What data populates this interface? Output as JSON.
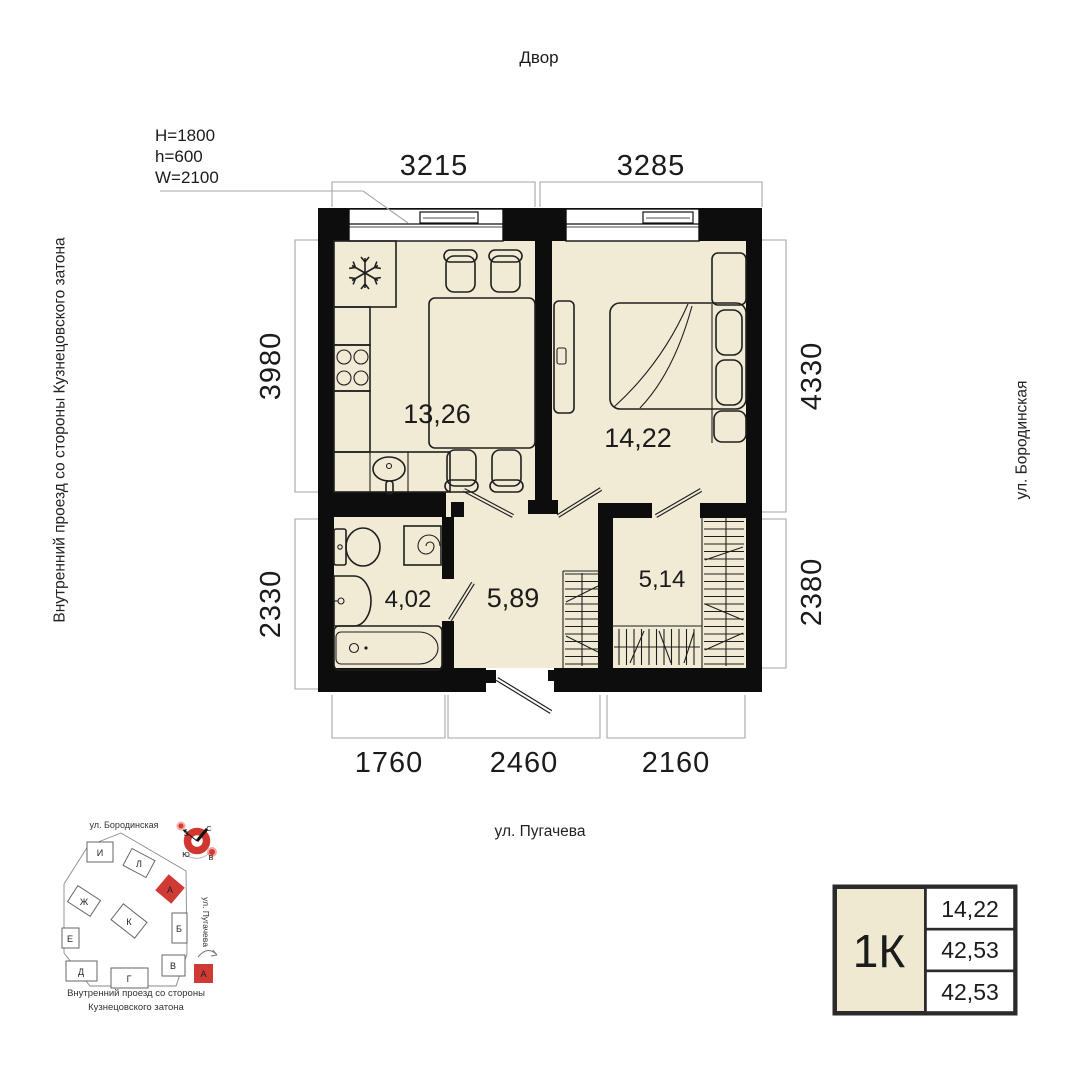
{
  "colors": {
    "floor": "#f1ebd5",
    "wall": "#0d0d0d",
    "accent_red": "#cf3a35",
    "dim_gray": "#a6a6a6",
    "card_border": "#2b2b2b"
  },
  "header": {
    "courtyard": "Двор"
  },
  "window_spec": {
    "l1": "H=1800",
    "l2": "h=600",
    "l3": "W=2100"
  },
  "dims": {
    "top": [
      "3215",
      "3285"
    ],
    "left": [
      "3980",
      "2330"
    ],
    "right": [
      "4330",
      "2380"
    ],
    "bottom": [
      "1760",
      "2460",
      "2160"
    ]
  },
  "rooms": {
    "kitchen": "13,26",
    "bedroom": "14,22",
    "bath": "4,02",
    "hall": "5,89",
    "wardrobe": "5,14"
  },
  "streets": {
    "bottom": "ул. Пугачева",
    "right": "ул. Бородинская",
    "left": "Внутренний проезд со стороны Кузнецовского затона"
  },
  "site": {
    "street_top": "ул. Бородинская",
    "street_right": "ул. Пугачева",
    "cap1": "Внутренний проезд со стороны",
    "cap2": "Кузнецовского затона",
    "buildings": {
      "i": "И",
      "l": "Л",
      "zh": "Ж",
      "k": "К",
      "e": "Е",
      "b": "Б",
      "d": "Д",
      "g": "Г",
      "v": "В"
    },
    "highlight": "А",
    "compass": {
      "n": "С",
      "s": "Ю",
      "w": "З",
      "e": "В"
    }
  },
  "card": {
    "type": "1К",
    "r1": "14,22",
    "r2": "42,53",
    "r3": "42,53"
  }
}
